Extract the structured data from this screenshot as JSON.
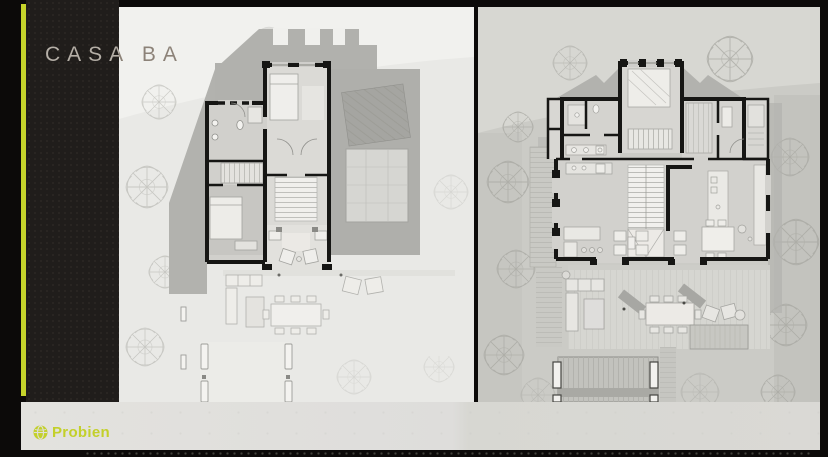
{
  "slide": {
    "title": "CASA BA"
  },
  "brand": {
    "name": "Probien",
    "icon": "globe-icon",
    "color": "#c3d02a"
  },
  "theme": {
    "background": "#0c0a09",
    "accent_stripe": "#c6d42b",
    "left_panel_bg": "#e9e9e6",
    "right_panel_bg": "#cbcbc6",
    "footer_bg": "#dedddb",
    "title_color_on_dark": "#b5afa7",
    "title_color_on_light": "#8c8278"
  },
  "panels": {
    "left": {
      "alt": "floor plan - upper level"
    },
    "right": {
      "alt": "floor plan - ground level"
    }
  }
}
